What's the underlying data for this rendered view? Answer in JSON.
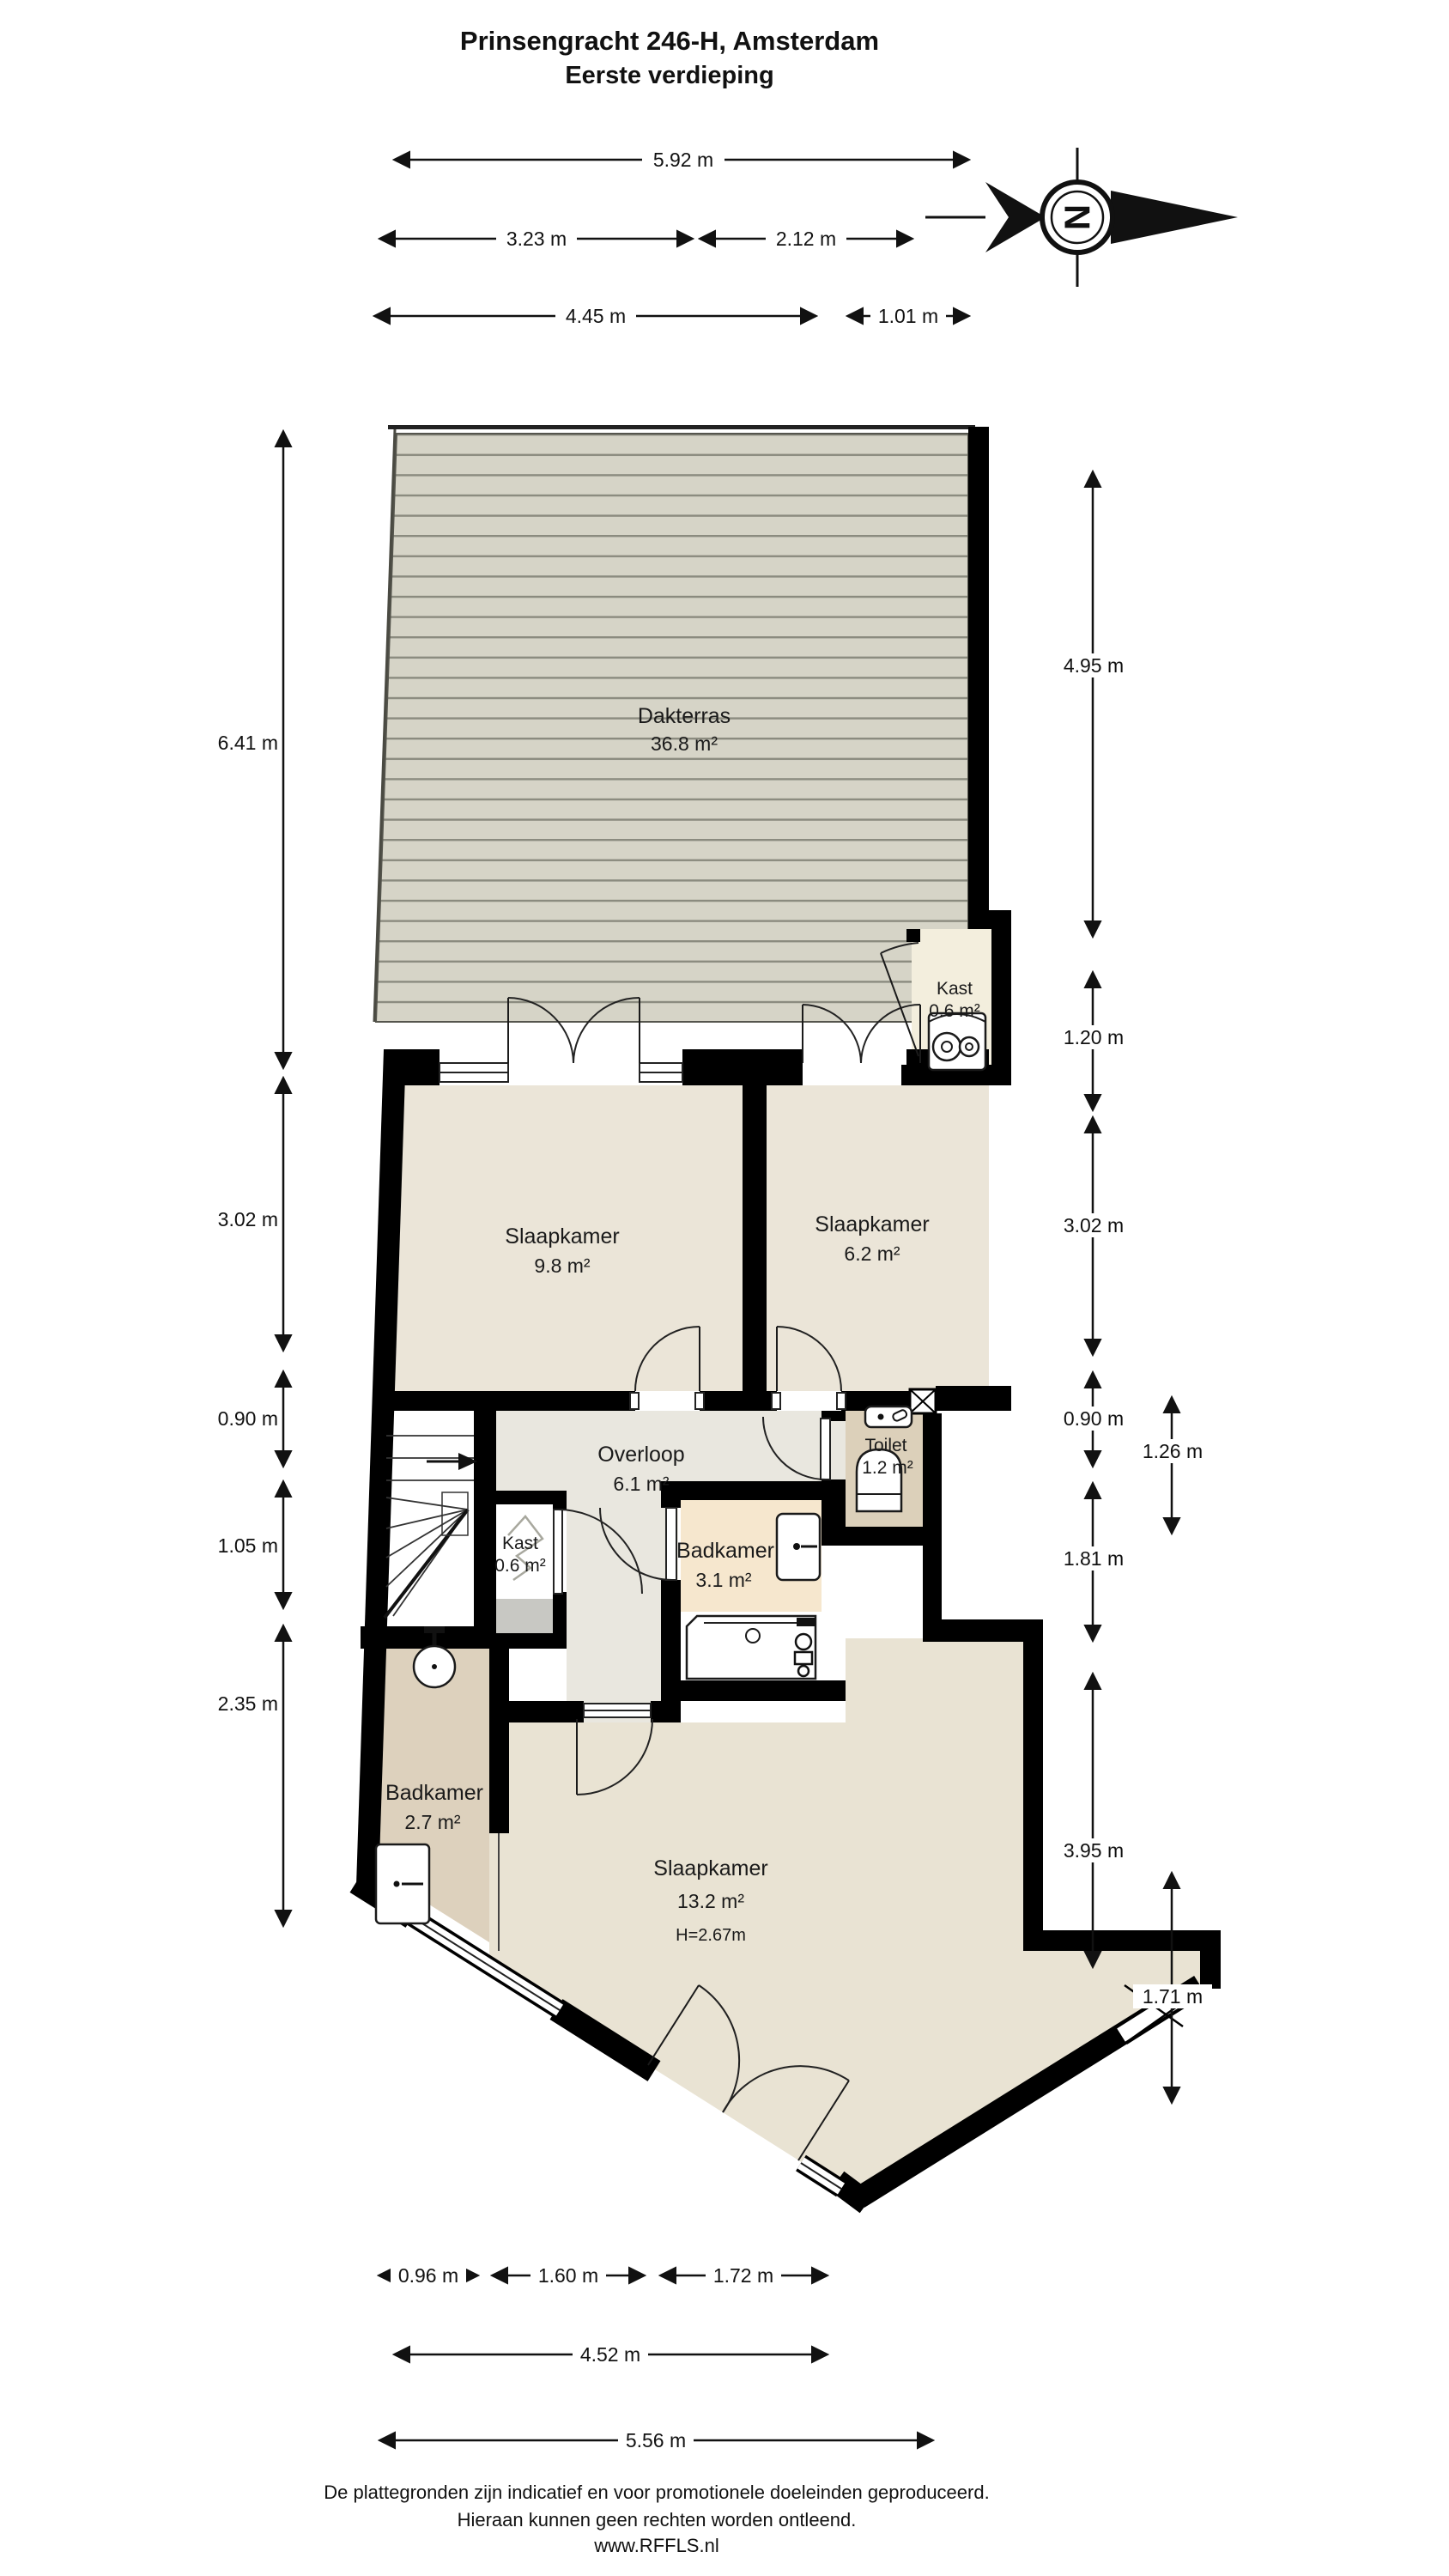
{
  "title": {
    "line1": "Prinsengracht 246-H, Amsterdam",
    "line2": "Eerste verdieping"
  },
  "compass": {
    "letter": "N"
  },
  "rooms": {
    "dakterras": {
      "name": "Dakterras",
      "area": "36.8 m²"
    },
    "slaapkamer1": {
      "name": "Slaapkamer",
      "area": "9.8 m²"
    },
    "slaapkamer2": {
      "name": "Slaapkamer",
      "area": "6.2 m²"
    },
    "kast_boven": {
      "name": "Kast",
      "area": "0.6 m²"
    },
    "overloop": {
      "name": "Overloop",
      "area": "6.1 m²"
    },
    "toilet": {
      "name": "Toilet",
      "area": "1.2 m²"
    },
    "kast_onder": {
      "name": "Kast",
      "area": "0.6 m²"
    },
    "badkamer1": {
      "name": "Badkamer",
      "area": "3.1 m²"
    },
    "badkamer2": {
      "name": "Badkamer",
      "area": "2.7 m²"
    },
    "slaapkamer3": {
      "name": "Slaapkamer",
      "area": "13.2 m²",
      "height": "H=2.67m"
    }
  },
  "dimensions": {
    "top": [
      "5.92 m",
      "3.23 m",
      "2.12 m",
      "4.45 m",
      "1.01 m"
    ],
    "left": [
      "6.41 m",
      "3.02 m",
      "0.90 m",
      "1.05 m",
      "2.35 m"
    ],
    "right": [
      "4.95 m",
      "1.20 m",
      "3.02 m",
      "0.90 m",
      "1.26 m",
      "1.81 m",
      "3.95 m",
      "1.71 m"
    ],
    "bottom": [
      "0.96 m",
      "1.60 m",
      "1.72 m",
      "4.52 m",
      "5.56 m"
    ]
  },
  "footer": {
    "line1": "De plattegronden zijn indicatief en voor promotionele doeleinden geproduceerd.",
    "line2": "Hieraan kunnen geen rechten worden ontleend.",
    "line3": "www.RFFLS.nl"
  },
  "colors": {
    "wall": "#000000",
    "deck": "#d6d4c7",
    "deck_line": "#8b8b7f",
    "bedroom_floor": "#ebe5d8",
    "landing_floor": "#e9e7df",
    "toilet_floor": "#dcd0ba",
    "bathroom1_floor": "#f6e7ce",
    "bathroom2_floor": "#ddd1bd",
    "closet_floor": "#f3eedd",
    "closet_gray": "#c8c8c3"
  }
}
